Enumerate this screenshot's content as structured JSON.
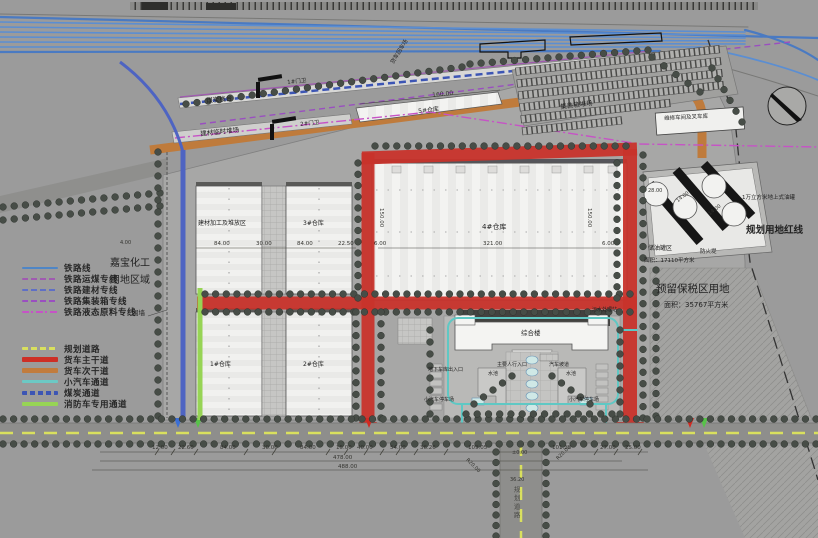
{
  "legend": {
    "rail_group": [
      {
        "label": "铁路线",
        "color": "#4f86c6",
        "pattern": "solid",
        "weight": 2
      },
      {
        "label": "铁路运煤专线",
        "color": "#a05ab0",
        "pattern": "dashed",
        "weight": 2
      },
      {
        "label": "铁路建材专线",
        "color": "#5f6fc6",
        "pattern": "dashed",
        "weight": 2
      },
      {
        "label": "铁路集装箱专线",
        "color": "#9a4fc0",
        "pattern": "dashed",
        "weight": 2
      },
      {
        "label": "铁路液态原料专线",
        "color": "#c653c6",
        "pattern": "dashdot",
        "weight": 2
      }
    ],
    "road_group": [
      {
        "label": "规划道路",
        "color": "#d9e05e",
        "pattern": "dashed",
        "weight": 3
      },
      {
        "label": "货车主干道",
        "color": "#cd2f26",
        "pattern": "solid",
        "weight": 5
      },
      {
        "label": "货车次干道",
        "color": "#c17c3e",
        "pattern": "solid",
        "weight": 5
      },
      {
        "label": "小汽车通道",
        "color": "#6cc9c4",
        "pattern": "solid",
        "weight": 3
      },
      {
        "label": "煤炭通道",
        "color": "#3c55b4",
        "pattern": "dashed-thick",
        "weight": 4
      },
      {
        "label": "消防车专用通道",
        "color": "#97d455",
        "pattern": "solid",
        "weight": 4
      }
    ]
  },
  "site_labels": {
    "owner_line1": "嘉宝化工",
    "owner_line2": "用地区域",
    "fence": "围墙"
  },
  "facilities": {
    "coal_platform": "煤炭栈台",
    "material_temp_yard": "建材临时堆场",
    "gate1": "1#门卫",
    "gate2": "2#门卫",
    "truck_turnaround": "货车回车场",
    "warehouse5": "5#仓库",
    "container_yard": "集装箱堆场",
    "repair_shop": "维修车间及叉车库",
    "material_processing": "建材加工及堆放区",
    "warehouse1": "1#仓库",
    "warehouse2": "2#仓库",
    "warehouse3": "3#仓库",
    "warehouse4": "4#仓库",
    "office": "综合楼",
    "garage_entry": "地下车库出入口",
    "pedestrian_entry": "主要人行入口",
    "car_ramp": "汽车坡道",
    "pool": "水池",
    "car_parking": "小汽车停车场",
    "sewage": "污水处理站",
    "planned_city_road": "规划道路"
  },
  "right_zone": {
    "red_line": "规划用地红线",
    "reserved": "预留保税区用地",
    "reserved_area": "面积：35767平方米",
    "tank_zone": "储油罐区",
    "tank_zone_area": "面积：17110平方米",
    "fire_dike": "防火堤",
    "tank_note": "1万立方米地上式油罐"
  },
  "dimensions": {
    "bottom_chain": [
      "12.00",
      "22.60",
      "84.00",
      "30.00",
      "84.00",
      "15.00",
      "40.00",
      "54.00",
      "36.26",
      "109.05",
      "101.18",
      "27.00",
      "25.00"
    ],
    "totals": [
      "478.00",
      "488.00"
    ],
    "warehouse_row": [
      "84.00",
      "30.00",
      "84.00",
      "22.50"
    ],
    "big_warehouse": {
      "left": "6.00",
      "width": "321.00",
      "right": "6.00",
      "depth_l": "150.00",
      "depth_r": "150.00"
    },
    "narrow_warehouse": "160.00",
    "tanks": [
      "28.00",
      "14.00",
      "14.00"
    ],
    "road": {
      "level": "±0.00",
      "width": "36.20",
      "r1": "R20.00",
      "r2": "R20.00"
    },
    "fence_offset": "4.00"
  }
}
